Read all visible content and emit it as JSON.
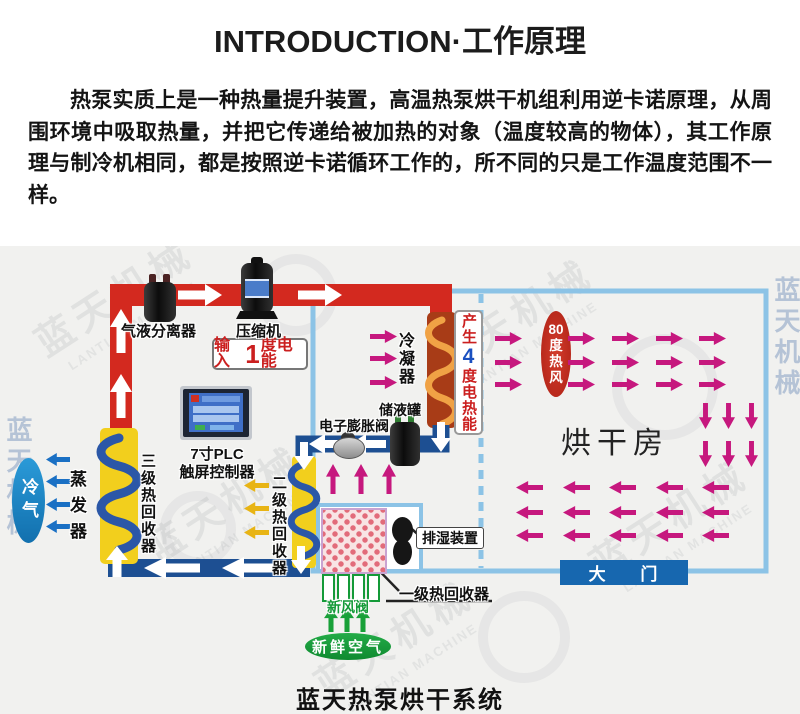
{
  "header": {
    "title": "INTRODUCTION·工作原理",
    "paragraph": "热泵实质上是一种热量提升装置，高温热泵烘干机组利用逆卡诺原理，从周围环境中吸取热量，并把它传递给被加热的对象（温度较高的物体），其工作原理与制冷机相同，都是按照逆卡诺循环工作的，所不同的只是工作温度范围不一样。"
  },
  "diagram": {
    "caption": "蓝天热泵烘干系统",
    "labels": {
      "separator": "气液分离器",
      "compressor": "压缩机",
      "input_energy": {
        "prefix": "输入",
        "big": "1",
        "suffix": "度电能"
      },
      "condenser": "冷凝器",
      "heat_output": {
        "prefix": "产生",
        "big": "4",
        "suffix": "度电热能"
      },
      "tank": "储液罐",
      "expansion_valve": "电子膨胀阀",
      "plc_line1": "7寸PLC",
      "plc_line2": "触屏控制器",
      "evaporator": "蒸发器",
      "cold_air": "冷气",
      "stage3": "三级热回收器",
      "stage2": "二级热回收器",
      "stage1": "一级热回收器",
      "dehumidifier": "排湿装置",
      "fresh_air_valve": "新风阀",
      "fresh_air": "新鲜空气",
      "drying_room": "烘干房",
      "hot_air": "80\n度\n热\n风",
      "door": "大 门"
    },
    "watermark": {
      "cn": "蓝天机械",
      "en": "LANTIAN MACHINE"
    }
  },
  "colors": {
    "hot_pipe": "#d3291f",
    "cold_pipe": "#1d4f92",
    "room_border": "#8cc3e6",
    "flow_arrow": "#c6187e",
    "coil_box": "#f2cf1d",
    "coil_tube": "#2b57a7",
    "condenser_box": "#a83c17",
    "condenser_tube": "#f0a245",
    "green": "#18a038",
    "blue_arrow": "#1a70c4",
    "yellow_arrow": "#e8b414",
    "hot_air_oval": "#c12c20",
    "cold_air_oval": "#1d8dcb",
    "door_bar": "#1767af"
  }
}
